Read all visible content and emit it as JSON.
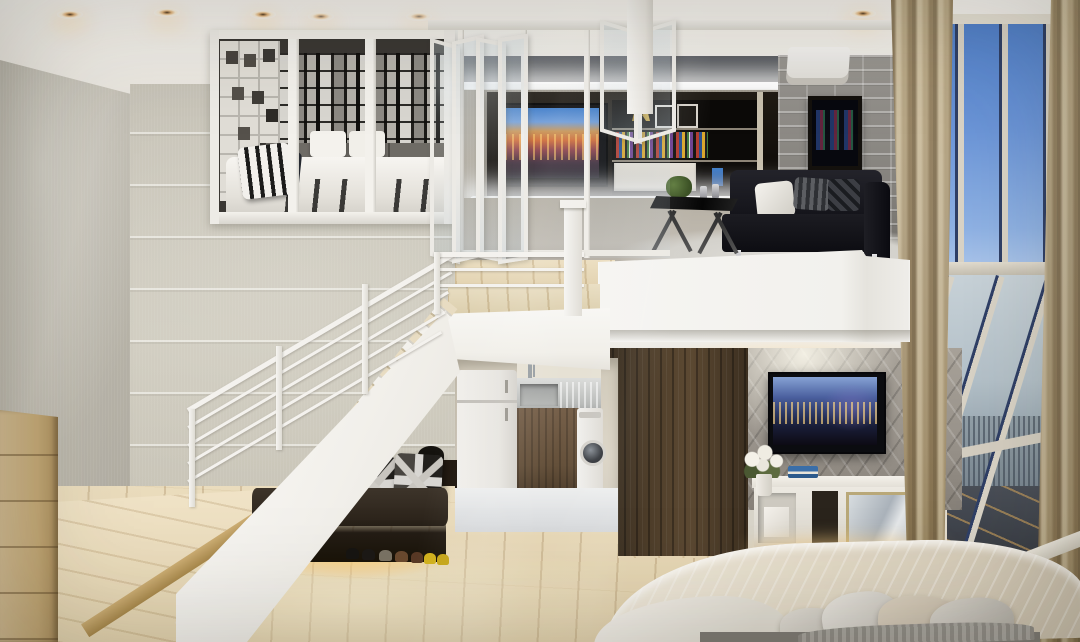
{
  "scene": {
    "type": "interior-architectural-render",
    "description": "Modern duplex loft apartment: upper mezzanine with glass-walled bedroom and living lounge, white open staircase with under-stair shoe bench, compact kitchen and laundry nook, lower bedroom with media console, and floor-to-ceiling city-view windows.",
    "areas": {
      "ceiling": {
        "label": "White ceiling with warm recessed spotlights"
      },
      "loft_bedroom": {
        "label": "Glass-partitioned loft bedroom with photo-collage wall and striped bedding"
      },
      "upper_living": {
        "label": "Mezzanine lounge with black leather sofa, backlit media wall, TV and brick accent wall"
      },
      "staircase": {
        "label": "White staircase with thin-bar railing"
      },
      "under_stair": {
        "label": "Under-stair bench with Union Jack cushions, warm LED glow and shoe row"
      },
      "kitchen_laundry": {
        "label": "Kitchen nook with fridge, sink, wood cabinet and front-load washer"
      },
      "lower_bedroom": {
        "label": "Lower bedroom with dark wood wall, 3D feature wall, wall TV, white console and beige bed"
      },
      "window_wall": {
        "label": "Floor-to-ceiling windows with blue sky and aerial city view, tan curtains"
      },
      "entry_platform": {
        "label": "Raised light-wood entry platform and wardrobe"
      }
    },
    "palette": {
      "ceiling_white": "#f4f2ee",
      "wall_beige": "#c9c5ba",
      "stair_white": "#f5f4f0",
      "wood_floor": "#e9dabb",
      "dark_wood": "#4a3a29",
      "sofa_black": "#17171c",
      "brick_gray": "#8d8a84",
      "window_sky": "#6b95d8",
      "curtain_tan": "#b2a283",
      "led_warm": "#f2c070",
      "shoe_yellow": "#d4b41c"
    }
  }
}
